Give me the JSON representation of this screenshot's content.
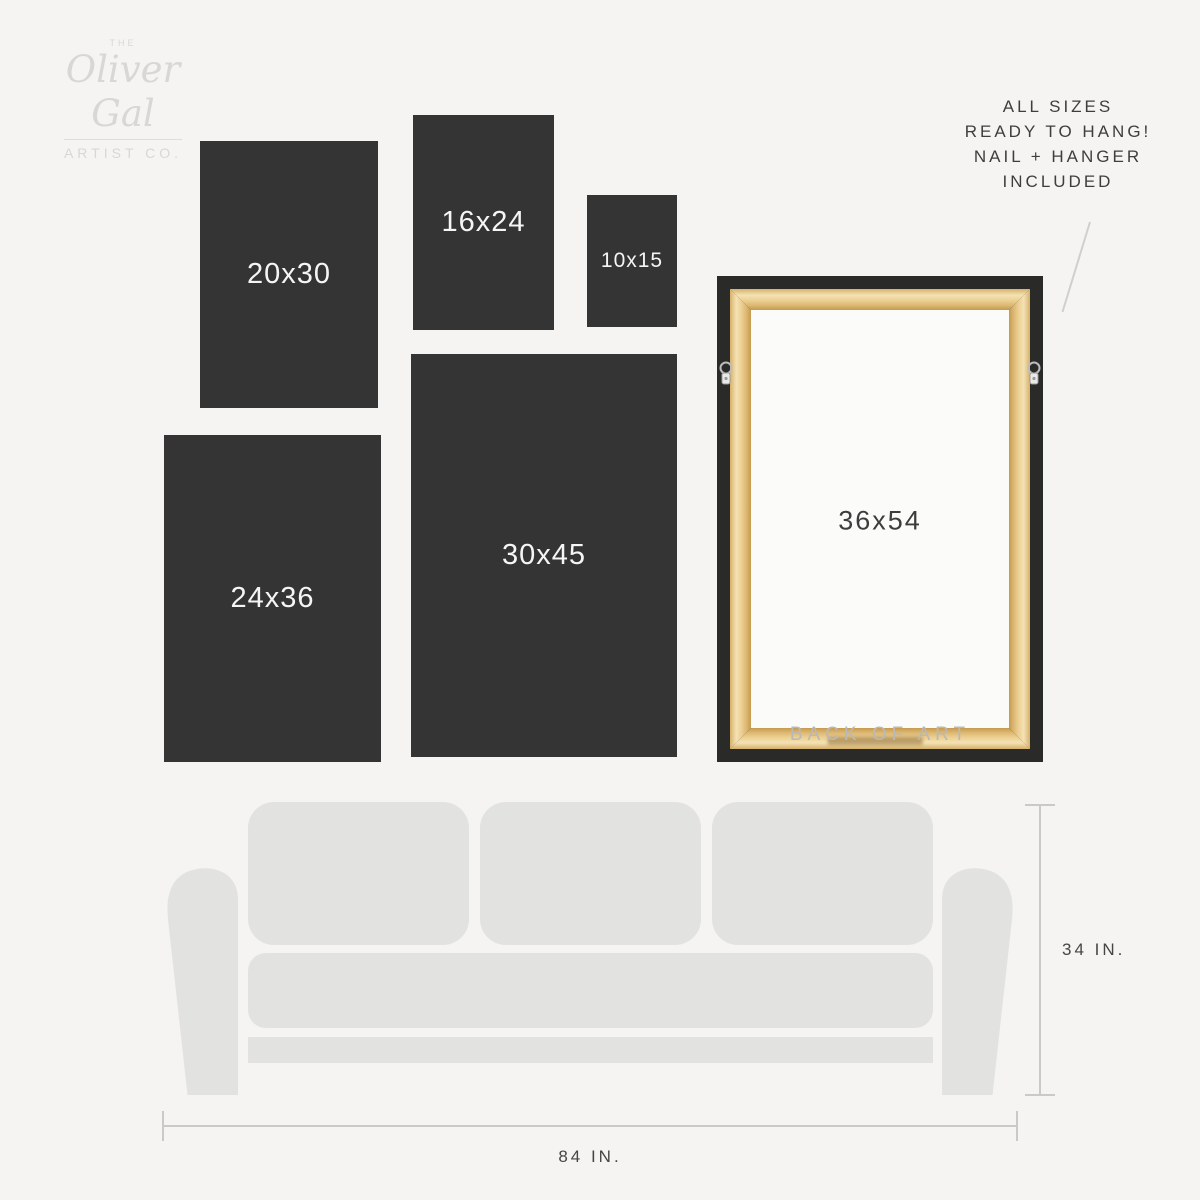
{
  "logo": {
    "the": "THE",
    "name": "Oliver Gal",
    "subtitle": "ARTIST CO."
  },
  "note": {
    "lines": [
      "ALL SIZES",
      "READY TO HANG!",
      "NAIL + HANGER",
      "INCLUDED"
    ]
  },
  "sizes": [
    {
      "label": "20x30"
    },
    {
      "label": "16x24"
    },
    {
      "label": "10x15"
    },
    {
      "label": "24x36"
    },
    {
      "label": "30x45"
    }
  ],
  "frame": {
    "size_label": "36x54",
    "caption": "BACK OF ART"
  },
  "sofa_dimensions": {
    "height": "34 IN.",
    "width": "84 IN."
  },
  "colors": {
    "background": "#f5f4f2",
    "panel_dark": "#343434",
    "panel_text": "#f5f5f5",
    "sofa_gray": "#e2e2e0",
    "dimension_line": "#c9c9c7",
    "text_dark": "#3e3e3e",
    "logo_gray": "#d7d7d4",
    "frame_black": "#2a2a29",
    "wood_light": "#f4e2b4",
    "wood_mid": "#eccf92",
    "wood_dark": "#c59a4e",
    "caption_gray": "#b9b9b7"
  }
}
